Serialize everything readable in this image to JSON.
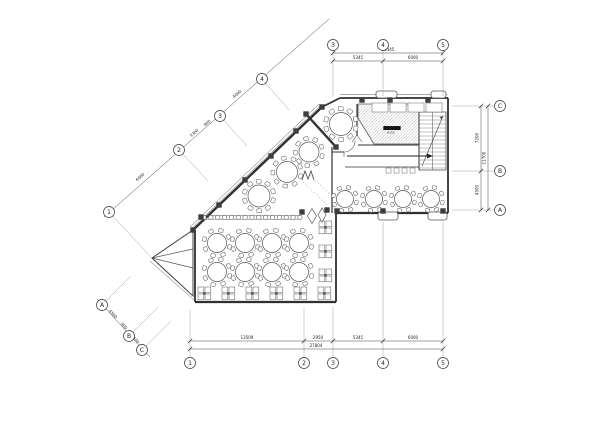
{
  "meta": {
    "title": "restaurant-floor-plan",
    "bg": "#ffffff",
    "ink": "#2f2f2f",
    "width": 600,
    "height": 424
  },
  "plan": {
    "stage": {
      "label": "▆▆▆▆▆",
      "sublabel": "8155",
      "label_x": 392,
      "label_y": 129,
      "points": [
        [
          358,
          104
        ],
        [
          419,
          104
        ],
        [
          419,
          144
        ],
        [
          374,
          144
        ],
        [
          358,
          118
        ]
      ]
    },
    "walls": [
      [
        340,
        98,
        448,
        98,
        1.8
      ],
      [
        448,
        98,
        448,
        213,
        1.8
      ],
      [
        448,
        213,
        336,
        213,
        2.2
      ],
      [
        336,
        213,
        336,
        302,
        1.8
      ],
      [
        336,
        302,
        195,
        302,
        2.2
      ],
      [
        195,
        302,
        195,
        230,
        1.8
      ],
      [
        193,
        230,
        322,
        107,
        2.4
      ],
      [
        322,
        107,
        340,
        98,
        1.8
      ]
    ],
    "interior_walls": [
      [
        306,
        114,
        336,
        147,
        2.4
      ],
      [
        332,
        147,
        332,
        213,
        1.2
      ],
      [
        332,
        152,
        344,
        152,
        1.0
      ],
      [
        357,
        104,
        357,
        136,
        1.2
      ],
      [
        358,
        145,
        419,
        145,
        1.0
      ],
      [
        419,
        104,
        419,
        170,
        1.0
      ],
      [
        345,
        167,
        419,
        167,
        0.8
      ]
    ],
    "thin_lines": [
      [
        190,
        227,
        319,
        104,
        0.5
      ],
      [
        191.6,
        228.6,
        320.6,
        105.6,
        0.5
      ],
      [
        340,
        94.5,
        447,
        94.5,
        0.5
      ],
      [
        150,
        261,
        194,
        300,
        0.5
      ],
      [
        152,
        258,
        193,
        249,
        0.7
      ],
      [
        152,
        258,
        193,
        268,
        0.7
      ],
      [
        357,
        135,
        352,
        142,
        0.6
      ],
      [
        357,
        135,
        362,
        142,
        0.6
      ],
      [
        344,
        152,
        344,
        157,
        0.6
      ]
    ],
    "door_paths": [
      "M344 152 A11 11 0 0 0 355 141"
    ],
    "triangle": [
      [
        152,
        258
      ],
      [
        193,
        230
      ],
      [
        193,
        296
      ]
    ],
    "stair": {
      "x": 419,
      "y": 112,
      "w": 27,
      "h": 58,
      "tread_step": 4,
      "mid_x": 432.5,
      "dir": [
        422,
        166,
        443,
        116
      ]
    },
    "arrow": [
      347,
      156,
      433,
      156
    ],
    "counters": [
      [
        372,
        103,
        16,
        9
      ],
      [
        390,
        103,
        16,
        9
      ],
      [
        408,
        103,
        16,
        9
      ],
      [
        426,
        103,
        16,
        9
      ]
    ],
    "small_rects": [
      [
        386,
        168,
        5,
        5
      ],
      [
        394,
        168,
        5,
        5
      ],
      [
        402,
        168,
        5,
        5
      ],
      [
        410,
        168,
        5,
        5
      ]
    ],
    "planters": [
      [
        376,
        91,
        21,
        7
      ],
      [
        431,
        91,
        15,
        7
      ],
      [
        378,
        212,
        20,
        8
      ],
      [
        428,
        212,
        19,
        8
      ]
    ],
    "dashed_lines": [
      [
        303,
        182,
        327,
        205
      ],
      [
        310,
        175,
        334,
        198
      ]
    ],
    "m_symbol": [
      [
        302,
        180
      ],
      [
        305,
        171
      ],
      [
        308,
        179
      ],
      [
        311,
        171
      ],
      [
        314,
        180
      ]
    ],
    "diamonds": [
      {
        "x": 312,
        "y": 216,
        "rx": 4.5,
        "ry": 7.5
      },
      {
        "x": 322,
        "y": 215,
        "rx": 4,
        "ry": 7
      }
    ],
    "balusters": {
      "x1": 202,
      "x2": 300,
      "y": 217.4,
      "step": 6.85,
      "r": 2.2,
      "rail1": 215.6,
      "rail2": 219.2
    },
    "columns": [
      [
        193,
        230
      ],
      [
        219,
        205
      ],
      [
        245,
        180
      ],
      [
        271,
        156
      ],
      [
        296,
        131
      ],
      [
        322,
        107
      ],
      [
        362,
        100
      ],
      [
        390,
        100
      ],
      [
        428,
        100
      ],
      [
        337,
        211
      ],
      [
        383,
        211
      ],
      [
        443,
        211
      ],
      [
        302,
        212
      ],
      [
        327,
        210
      ],
      [
        201,
        217
      ],
      [
        306,
        114
      ],
      [
        336,
        147
      ]
    ],
    "round_tables": [
      {
        "x": 341,
        "y": 124,
        "r": 11.5,
        "n": 10,
        "cs": 5.0
      },
      {
        "x": 309,
        "y": 152,
        "r": 10.0,
        "n": 9,
        "cs": 4.6
      },
      {
        "x": 287,
        "y": 172,
        "r": 10.5,
        "n": 9,
        "cs": 4.6
      },
      {
        "x": 259,
        "y": 196,
        "r": 11.0,
        "n": 10,
        "cs": 4.8
      },
      {
        "x": 345,
        "y": 199,
        "r": 8.5,
        "n": 8,
        "cs": 4.2
      },
      {
        "x": 374,
        "y": 199,
        "r": 8.5,
        "n": 8,
        "cs": 4.2
      },
      {
        "x": 403,
        "y": 199,
        "r": 8.5,
        "n": 8,
        "cs": 4.2
      },
      {
        "x": 431,
        "y": 199,
        "r": 8.5,
        "n": 8,
        "cs": 4.2
      },
      {
        "x": 217,
        "y": 243,
        "r": 9.5,
        "n": 8,
        "cs": 4.5
      },
      {
        "x": 245,
        "y": 243,
        "r": 9.5,
        "n": 8,
        "cs": 4.5
      },
      {
        "x": 272,
        "y": 243,
        "r": 9.5,
        "n": 8,
        "cs": 4.5
      },
      {
        "x": 299,
        "y": 243,
        "r": 9.5,
        "n": 8,
        "cs": 4.5
      },
      {
        "x": 217,
        "y": 272,
        "r": 9.5,
        "n": 8,
        "cs": 4.5
      },
      {
        "x": 245,
        "y": 272,
        "r": 9.5,
        "n": 8,
        "cs": 4.5
      },
      {
        "x": 272,
        "y": 272,
        "r": 9.5,
        "n": 8,
        "cs": 4.5
      },
      {
        "x": 299,
        "y": 272,
        "r": 9.5,
        "n": 8,
        "cs": 4.5
      }
    ],
    "booths": [
      [
        198,
        287
      ],
      [
        222,
        287
      ],
      [
        246,
        287
      ],
      [
        270,
        287
      ],
      [
        294,
        287
      ],
      [
        318,
        287
      ],
      [
        319,
        221
      ],
      [
        319,
        245
      ],
      [
        319,
        269
      ]
    ],
    "ext_lines": [
      [
        333,
        50.5,
        333,
        96
      ],
      [
        383,
        50.5,
        383,
        96
      ],
      [
        443,
        50.5,
        443,
        96
      ],
      [
        452,
        106,
        494,
        106
      ],
      [
        452,
        171,
        494,
        171
      ],
      [
        452,
        210,
        494,
        210
      ],
      [
        190,
        310,
        190,
        357
      ],
      [
        304,
        307,
        304,
        357
      ],
      [
        333,
        307,
        333,
        357
      ],
      [
        383,
        222,
        383,
        357
      ],
      [
        443,
        222,
        443,
        357
      ],
      [
        109,
        212,
        152,
        258
      ],
      [
        179,
        150,
        208,
        181
      ],
      [
        220,
        116,
        247,
        146
      ],
      [
        262,
        79,
        289,
        110
      ],
      [
        102,
        305,
        131,
        276
      ],
      [
        129,
        336,
        158,
        307
      ],
      [
        142,
        350,
        171,
        321
      ]
    ],
    "dim_lines": [
      {
        "pts": [
          333,
          61,
          443,
          61
        ],
        "ticks": [
          [
            333,
            61
          ],
          [
            383,
            61
          ],
          [
            443,
            61
          ]
        ]
      },
      {
        "pts": [
          333,
          53,
          443,
          53
        ],
        "ticks": [
          [
            333,
            53
          ],
          [
            443,
            53
          ]
        ]
      },
      {
        "pts": [
          481,
          106,
          481,
          210
        ],
        "ticks": [
          [
            481,
            106
          ],
          [
            481,
            171
          ],
          [
            481,
            210
          ]
        ]
      },
      {
        "pts": [
          488,
          106,
          488,
          210
        ],
        "ticks": [
          [
            488,
            106
          ],
          [
            488,
            210
          ]
        ]
      },
      {
        "pts": [
          190,
          341,
          443,
          341
        ],
        "ticks": [
          [
            190,
            341
          ],
          [
            304,
            341
          ],
          [
            333,
            341
          ],
          [
            383,
            341
          ],
          [
            443,
            341
          ]
        ]
      },
      {
        "pts": [
          190,
          349,
          443,
          349
        ],
        "ticks": [
          [
            190,
            349
          ],
          [
            443,
            349
          ]
        ]
      },
      {
        "pts": [
          104,
          217,
          329,
          19
        ],
        "ticks": [
          [
            109,
            212
          ],
          [
            179,
            150
          ],
          [
            220,
            116
          ],
          [
            262,
            79
          ]
        ]
      },
      {
        "pts": [
          97,
          299,
          150,
          357
        ],
        "ticks": [
          [
            102,
            305
          ],
          [
            129,
            336
          ],
          [
            142,
            350
          ]
        ]
      }
    ],
    "dim_labels": [
      {
        "t": "5345",
        "x": 358,
        "y": 59,
        "r": 0
      },
      {
        "t": "6000",
        "x": 413,
        "y": 59,
        "r": 0
      },
      {
        "t": "11345",
        "x": 388,
        "y": 51,
        "r": 0
      },
      {
        "t": "7200",
        "x": 478.5,
        "y": 138,
        "r": -90
      },
      {
        "t": "4500",
        "x": 478.5,
        "y": 190,
        "r": -90
      },
      {
        "t": "11700",
        "x": 485.5,
        "y": 158,
        "r": -90
      },
      {
        "t": "13509",
        "x": 247,
        "y": 339,
        "r": 0
      },
      {
        "t": "2950",
        "x": 318,
        "y": 339,
        "r": 0
      },
      {
        "t": "5345",
        "x": 358,
        "y": 339,
        "r": 0
      },
      {
        "t": "6000",
        "x": 413,
        "y": 339,
        "r": 0
      },
      {
        "t": "27804",
        "x": 316,
        "y": 347,
        "r": 0
      },
      {
        "t": "6000",
        "x": 141,
        "y": 178,
        "r": -41
      },
      {
        "t": "3300",
        "x": 195,
        "y": 134,
        "r": -41
      },
      {
        "t": "900",
        "x": 208,
        "y": 124,
        "r": -41
      },
      {
        "t": "4000",
        "x": 238,
        "y": 95,
        "r": -41
      },
      {
        "t": "4500",
        "x": 112,
        "y": 315,
        "r": 47
      },
      {
        "t": "900",
        "x": 123,
        "y": 327,
        "r": 47
      },
      {
        "t": "2400",
        "x": 134,
        "y": 340,
        "r": 47
      }
    ],
    "grid_bubbles": [
      {
        "t": "3",
        "x": 333,
        "y": 45
      },
      {
        "t": "4",
        "x": 383,
        "y": 45
      },
      {
        "t": "5",
        "x": 443,
        "y": 45
      },
      {
        "t": "C",
        "x": 500,
        "y": 106
      },
      {
        "t": "B",
        "x": 500,
        "y": 171
      },
      {
        "t": "A",
        "x": 500,
        "y": 210
      },
      {
        "t": "1",
        "x": 190,
        "y": 363
      },
      {
        "t": "2",
        "x": 304,
        "y": 363
      },
      {
        "t": "3",
        "x": 333,
        "y": 363
      },
      {
        "t": "4",
        "x": 383,
        "y": 363
      },
      {
        "t": "5",
        "x": 443,
        "y": 363
      },
      {
        "t": "1",
        "x": 109,
        "y": 212
      },
      {
        "t": "2",
        "x": 179,
        "y": 150
      },
      {
        "t": "3",
        "x": 220,
        "y": 116
      },
      {
        "t": "4",
        "x": 262,
        "y": 79
      },
      {
        "t": "A",
        "x": 102,
        "y": 305
      },
      {
        "t": "B",
        "x": 129,
        "y": 336
      },
      {
        "t": "C",
        "x": 142,
        "y": 350
      }
    ]
  }
}
